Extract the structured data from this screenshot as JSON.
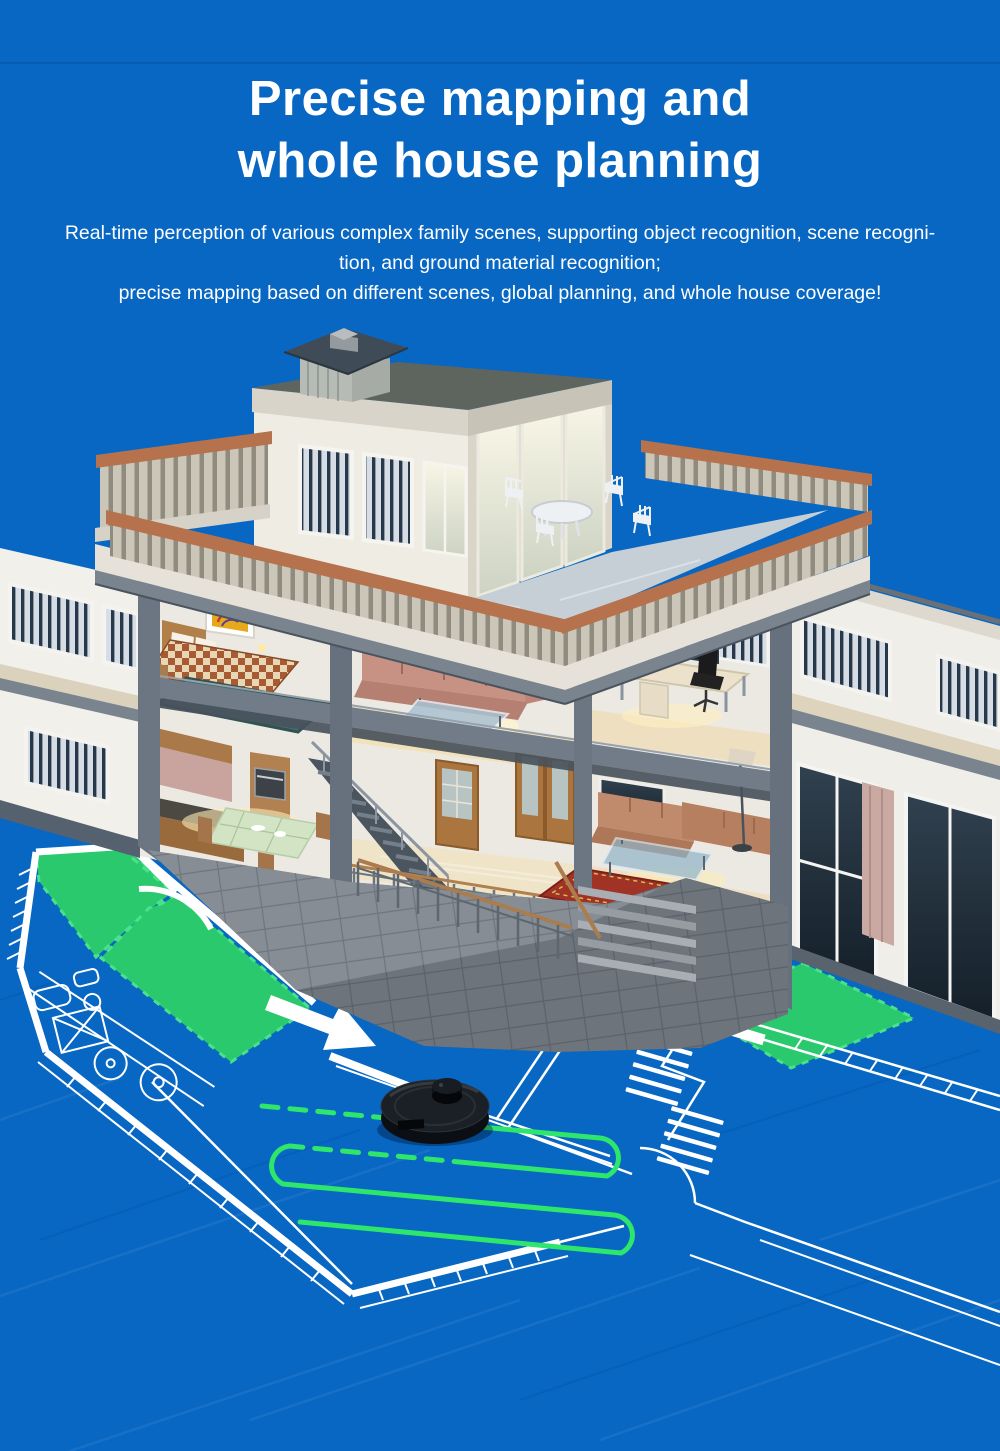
{
  "banner": {
    "background_color": "#0767c3",
    "title": {
      "line1": "Precise mapping and",
      "line2": "whole house planning"
    },
    "description": {
      "line1": "Real-time perception of various complex family scenes, supporting object recognition, scene recogni-",
      "line2": "tion, and ground material recognition;",
      "line3": "precise mapping based on different scenes, global planning, and whole house coverage!"
    }
  },
  "illustration": {
    "subject": "3D cutaway house with robot vacuum cleaning blueprint floor plan",
    "colors": {
      "background_blue": "#0767c3",
      "cleaned_zone_green": "#2bc96e",
      "cleaning_path_green": "#2ee66b",
      "blueprint_line_white": "#ffffff",
      "robot_body_black": "#14171c",
      "terrace_rail_terracotta": "#b5724d"
    }
  }
}
